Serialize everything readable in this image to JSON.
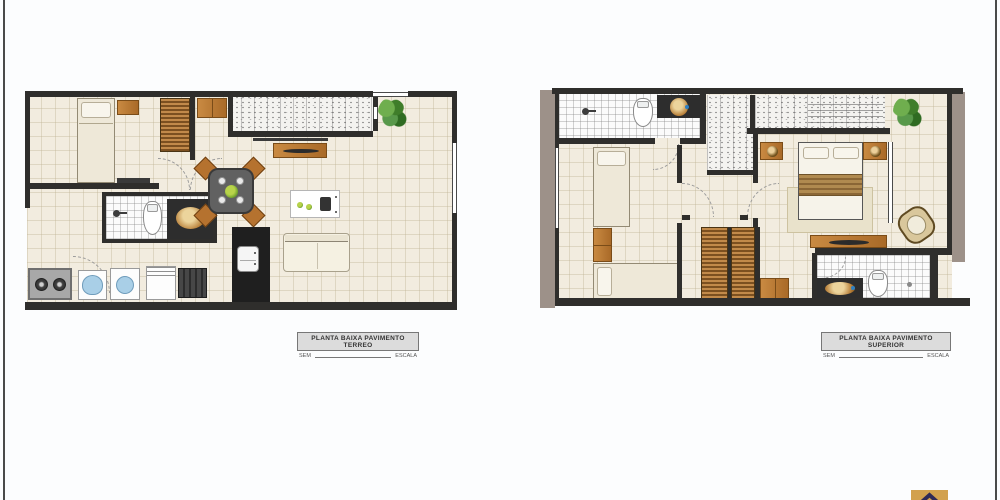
{
  "canvas": {
    "width": 1000,
    "height": 500,
    "background": "#fcfdfe"
  },
  "plans": [
    {
      "id": "terreo",
      "title": "PLANTA BAIXA PAVIMENTO TERREO",
      "scale_left": "SEM",
      "scale_right": "ESCALA",
      "rooms": [
        "dormitorio",
        "banheiro",
        "sala-jantar",
        "cozinha",
        "area-de-servico",
        "patio"
      ],
      "furniture": [
        "single-bed",
        "nightstand",
        "wardrobe",
        "cabinet",
        "tv-panel",
        "dining-table-4-chairs",
        "kitchen-island",
        "refrigerator",
        "sofa",
        "cooktop",
        "laundry-tub",
        "washing-machine",
        "sink-counter",
        "stove",
        "toilet",
        "shower",
        "gold-sink",
        "plant"
      ]
    },
    {
      "id": "superior",
      "title": "PLANTA BAIXA PAVIMENTO SUPERIOR",
      "scale_left": "SEM",
      "scale_right": "ESCALA",
      "rooms": [
        "dormitorio-solteiro",
        "banheiro",
        "hall",
        "dormitorio-casal",
        "banheiro-suite",
        "varanda"
      ],
      "furniture": [
        "single-bed",
        "single-bed",
        "nightstand",
        "wardrobe",
        "wardrobe",
        "double-bed",
        "nightstand-lamp",
        "nightstand-lamp",
        "rug",
        "dresser-tv",
        "wicker-chair",
        "toilet",
        "toilet",
        "shower",
        "gold-sink",
        "gold-sink",
        "plant",
        "stair-void"
      ]
    }
  ],
  "colors": {
    "wall": "#2f2e2c",
    "floor": "#f2ecdf",
    "tile_line": "#beb294",
    "white_tile": "#fbfbfb",
    "wood": "#b97a38",
    "wood_dark": "#7c5020",
    "taupe_wall": "#9d9189",
    "texture": "#f4f3f0",
    "sofa": "#f5f1e2",
    "blue": "#a9cfe7",
    "plant_green": "#4e8f35",
    "gold": "#b8803a",
    "label_bg": "#dcdcdc",
    "label_border": "#777777",
    "label_text": "#333333",
    "edge_line": "#4a4a4a"
  },
  "logo": {
    "icon": "roof-chevron-icon",
    "bg": "#d2a14e",
    "fg": "#2f2a57"
  }
}
